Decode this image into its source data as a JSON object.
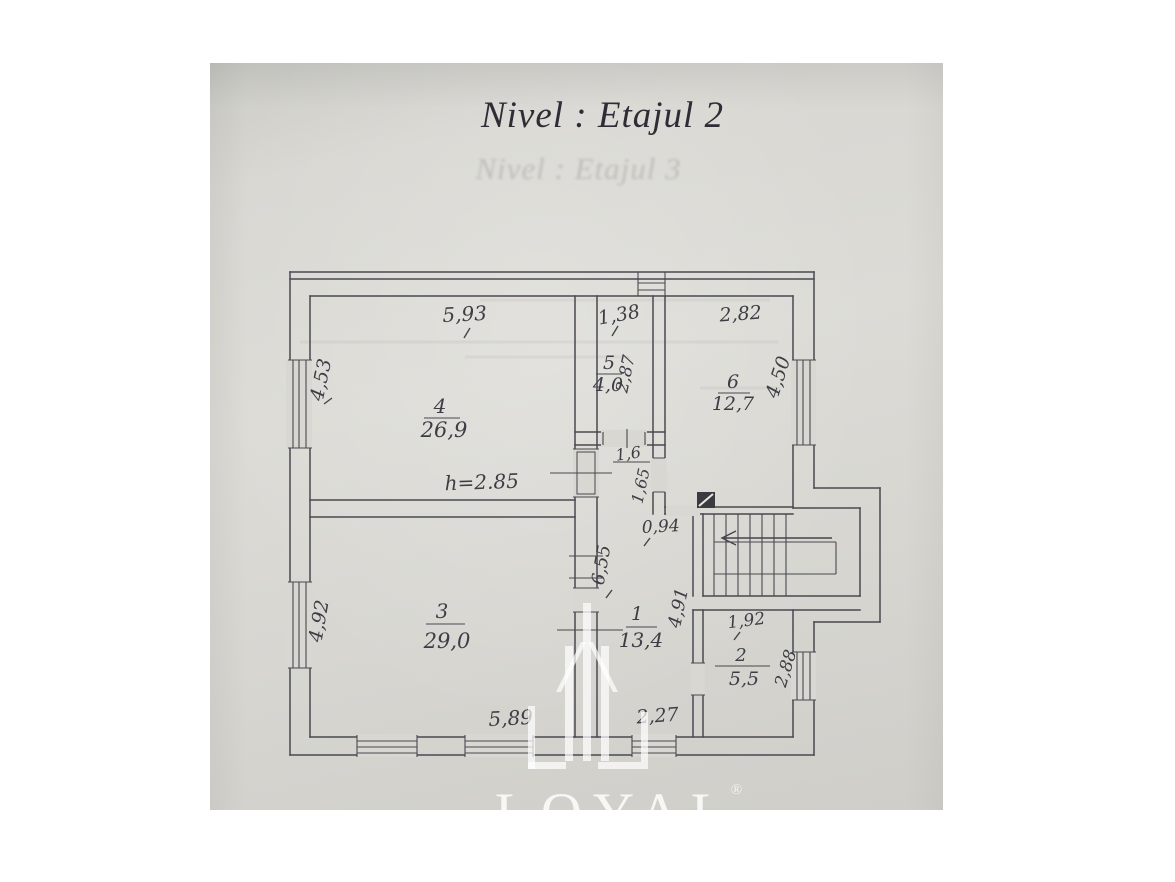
{
  "page": {
    "title": "Nivel : Etajul 2",
    "bleedthrough_title": "Nivel : Etajul 3"
  },
  "watermark": {
    "brand": "LOYAL",
    "registered_mark": "®"
  },
  "colors": {
    "paper": "#d8d7d2",
    "ink": "#45444a",
    "title_ink": "#2e2d35",
    "watermark": "#ffffff"
  },
  "plan": {
    "height_note": "h=2.85",
    "rooms": [
      {
        "id": "room-4",
        "number": "4",
        "area": "26,9"
      },
      {
        "id": "room-5",
        "number": "5",
        "area": "4,0"
      },
      {
        "id": "room-6",
        "number": "6",
        "area": "12,7"
      },
      {
        "id": "room-3",
        "number": "3",
        "area": "29,0"
      },
      {
        "id": "room-1",
        "number": "1",
        "area": "13,4"
      },
      {
        "id": "room-2",
        "number": "2",
        "area": "5,5"
      }
    ],
    "dimensions": {
      "top_room4": "5,93",
      "top_room5": "1,38",
      "top_room6": "2,82",
      "left_room4": "4,53",
      "left_room3": "4,92",
      "right_room6": "4,50",
      "right_room2": "2,88",
      "room5_side": "2,87",
      "hall_top": "1,6",
      "hall_side": "1,65",
      "stair_passage": "0,94",
      "hall_length": "6,55",
      "hall_height": "4,91",
      "room2_top": "1,92",
      "bottom_room3": "5,89",
      "bottom_hall": "2,27"
    }
  }
}
